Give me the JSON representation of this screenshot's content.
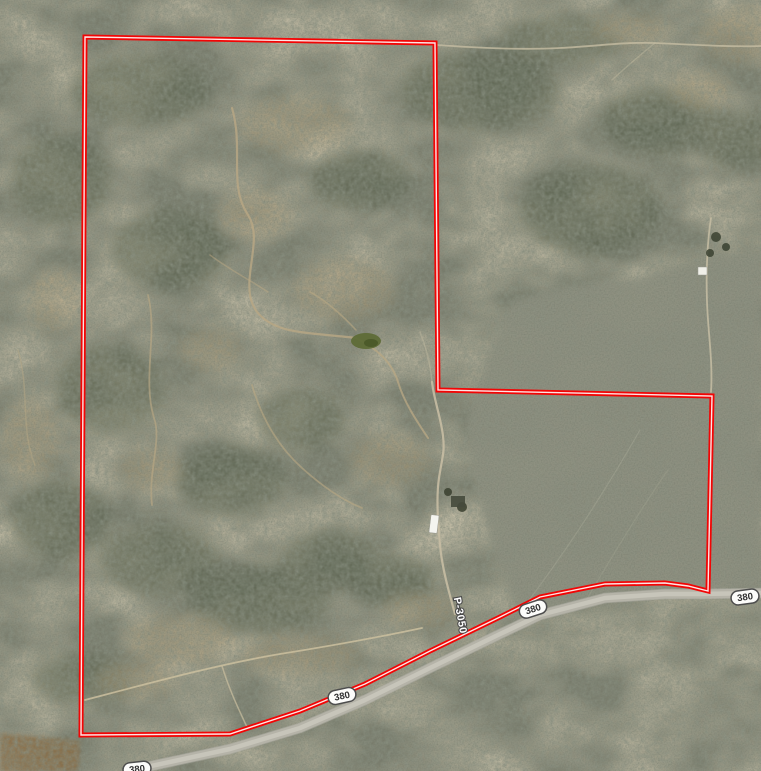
{
  "meta": {
    "view": "aerial satellite imagery with parcel overlay",
    "width_px": 761,
    "height_px": 771
  },
  "map": {
    "terrain": "desert scrubland with dirt washes, open grey fields, brown tilled field bottom-left, small ranch buildings",
    "parcel_boundary": {
      "color": "#f20505",
      "core_color": "#ffffff",
      "points": [
        [
          85,
          37
        ],
        [
          435,
          43
        ],
        [
          438,
          390
        ],
        [
          712,
          396
        ],
        [
          708,
          591
        ],
        [
          688,
          586
        ],
        [
          665,
          583
        ],
        [
          605,
          584
        ],
        [
          540,
          597
        ],
        [
          500,
          617
        ],
        [
          430,
          651
        ],
        [
          365,
          684
        ],
        [
          300,
          711
        ],
        [
          230,
          734
        ],
        [
          81,
          735
        ]
      ]
    },
    "highway": {
      "name": "380",
      "centerline": [
        [
          128,
          771
        ],
        [
          230,
          749
        ],
        [
          300,
          728
        ],
        [
          365,
          700
        ],
        [
          430,
          668
        ],
        [
          500,
          634
        ],
        [
          540,
          615
        ],
        [
          605,
          598
        ],
        [
          665,
          594
        ],
        [
          700,
          594
        ],
        [
          761,
          593
        ]
      ]
    },
    "route_shields": [
      {
        "label": "380",
        "x": 342,
        "y": 696,
        "rotation": -12
      },
      {
        "label": "380",
        "x": 533,
        "y": 609,
        "rotation": -18
      },
      {
        "label": "380",
        "x": 745,
        "y": 597,
        "rotation": -8
      },
      {
        "label": "380",
        "x": 137,
        "y": 769,
        "rotation": -6
      }
    ],
    "road_labels": [
      {
        "label": "P-3050",
        "x": 457,
        "y": 616,
        "rotation": 80
      }
    ]
  }
}
